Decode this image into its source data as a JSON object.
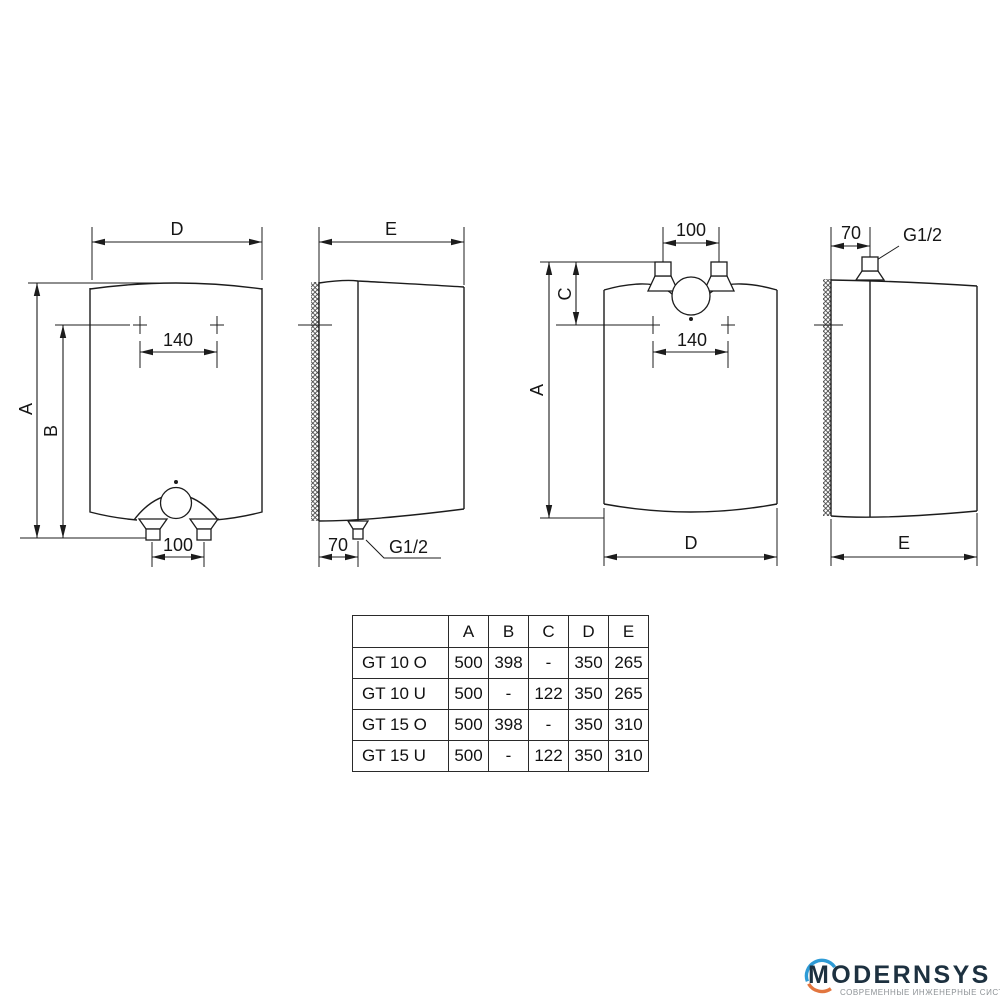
{
  "views": {
    "front_over": {
      "width_label": "D",
      "total_height_label": "A",
      "mount_height_label": "B",
      "mount_spacing_label": "140",
      "outlet_spacing_label": "100"
    },
    "side_over": {
      "depth_label": "E",
      "wall_offset_label": "70",
      "thread_label": "G1/2"
    },
    "front_under": {
      "inlet_spacing_label": "100",
      "mount_offset_label": "C",
      "total_height_label": "A",
      "mount_spacing_label": "140",
      "width_label": "D"
    },
    "side_under": {
      "wall_offset_label": "70",
      "thread_label": "G1/2",
      "depth_label": "E"
    }
  },
  "table": {
    "headers": [
      "",
      "A",
      "B",
      "C",
      "D",
      "E"
    ],
    "rows": [
      [
        "GT 10 O",
        "500",
        "398",
        "-",
        "350",
        "265"
      ],
      [
        "GT 10 U",
        "500",
        "-",
        "122",
        "350",
        "265"
      ],
      [
        "GT 15 O",
        "500",
        "398",
        "-",
        "350",
        "310"
      ],
      [
        "GT 15 U",
        "500",
        "-",
        "122",
        "350",
        "310"
      ]
    ]
  },
  "logo": {
    "brand": "MODERNSYS",
    "tagline": "СОВРЕМЕННЫЕ ИНЖЕНЕРНЫЕ СИСТЕМЫ"
  },
  "colors": {
    "line": "#1c1c1c",
    "logo_navy": "#1d3140",
    "logo_blue": "#2e9bd6",
    "logo_orange": "#e2763f",
    "logo_gray": "#8d9296"
  }
}
